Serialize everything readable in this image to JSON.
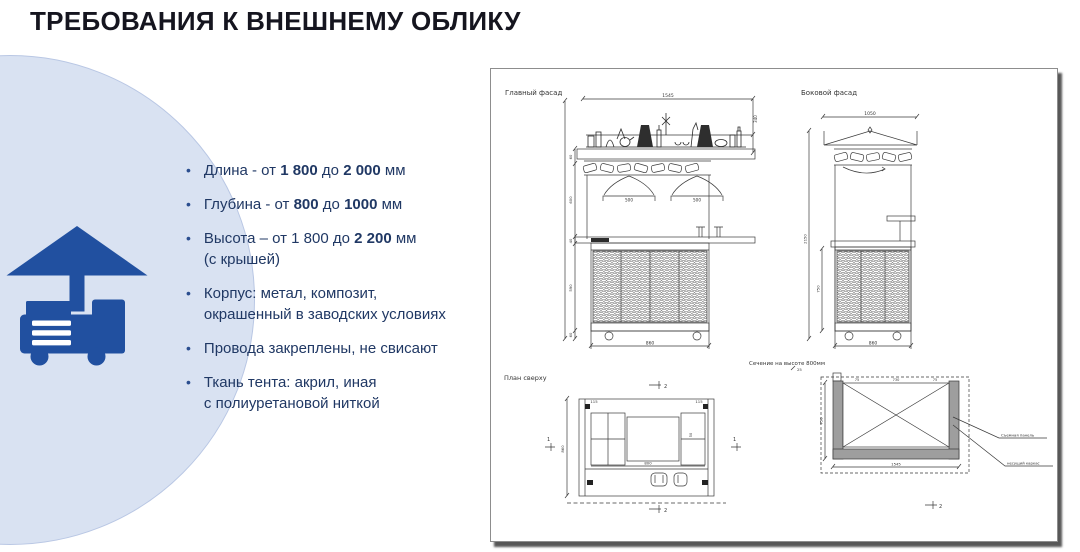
{
  "title": "ТРЕБОВАНИЯ К ВНЕШНЕМУ ОБЛИКУ",
  "colors": {
    "accent_blue": "#2150a0",
    "circle_background": "#d9e2f2",
    "bullet_text": "#203864",
    "title_text": "#15151f"
  },
  "icons": {
    "main": "trade-cart-icon"
  },
  "bullets": [
    {
      "runs": [
        {
          "t": "Длина - от "
        },
        {
          "t": "1 800",
          "b": 1
        },
        {
          "t": "  до "
        },
        {
          "t": "2 000",
          "b": 1
        },
        {
          "t": " мм"
        }
      ]
    },
    {
      "runs": [
        {
          "t": "Глубина - от  "
        },
        {
          "t": "800",
          "b": 1
        },
        {
          "t": "  до "
        },
        {
          "t": "1000",
          "b": 1
        },
        {
          "t": " мм"
        }
      ]
    },
    {
      "runs": [
        {
          "t": "Высота – от 1 800 до  "
        },
        {
          "t": "2 200",
          "b": 1
        },
        {
          "t": " мм\n(с крышей)"
        }
      ]
    },
    {
      "runs": [
        {
          "t": "Корпус:  метал, композит,\nокрашенный в заводских условиях"
        }
      ]
    },
    {
      "runs": [
        {
          "t": "Провода закреплены, не свисают"
        }
      ]
    },
    {
      "runs": [
        {
          "t": "Ткань тента: акрил, иная\nс полиуретановой ниткой"
        }
      ]
    }
  ],
  "drawing": {
    "main": {
      "label": "Главный фасад",
      "dim_top": "1545",
      "dim_right": "340",
      "lamp1": "500",
      "lamp2": "500",
      "dim_bottom": "860",
      "left_dims": [
        "60",
        "600",
        "40",
        "590",
        "60"
      ]
    },
    "side": {
      "label": "Боковой фасад",
      "dim_top": "1050",
      "dim_height": "2150",
      "dim_inner": "750",
      "dim_bottom": "860"
    },
    "plan": {
      "label": "План сверху",
      "wall_left": "115",
      "wall_right": "115",
      "inner_width": "800",
      "cell_right": "50",
      "depth": "860",
      "mark_cut_top": "2",
      "mark_cut_bottom": "2",
      "mark_side_left": "1",
      "mark_side_right": "1"
    },
    "section": {
      "label": "Сечение на высоте 800мм",
      "tab": "25",
      "top_left": "75",
      "top_center": "730",
      "top_right": "75",
      "dim_left": "750",
      "dim_bottom": "1545",
      "mark_cut": "2",
      "ann1": "Съемная панель",
      "ann2": "несущий каркас"
    }
  }
}
